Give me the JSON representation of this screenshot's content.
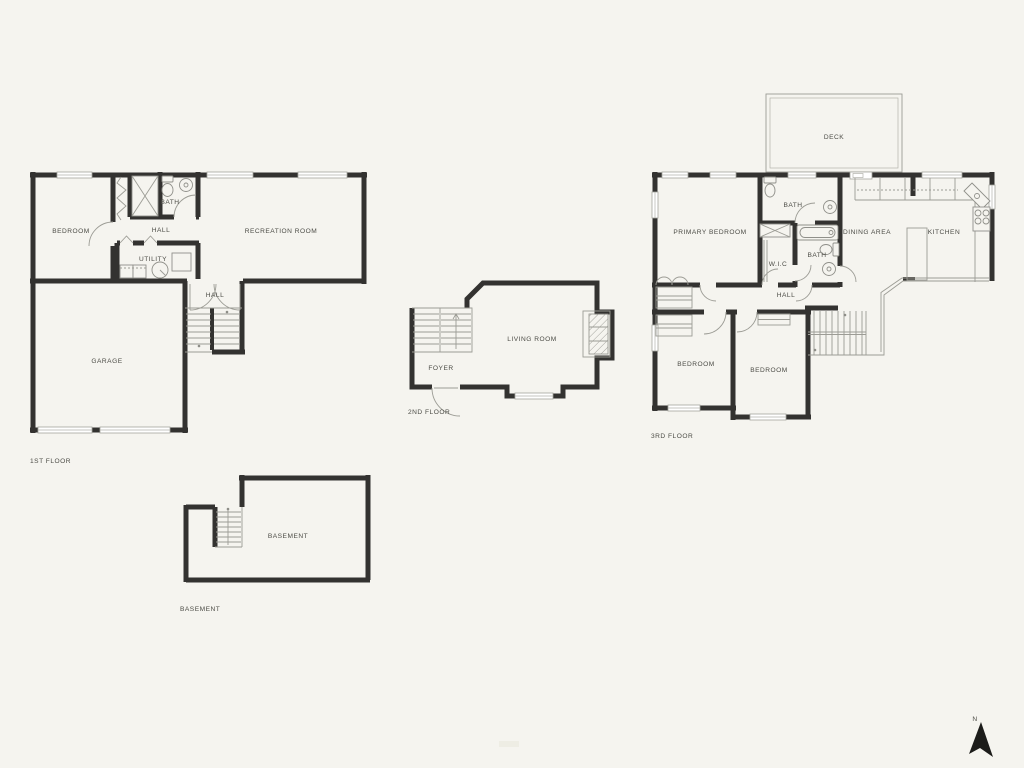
{
  "floors": {
    "first": {
      "caption": "1ST FLOOR",
      "rooms": {
        "bedroom": "BEDROOM",
        "bath": "BATH",
        "hall_upper": "HALL",
        "utility": "UTILITY",
        "recreation": "RECREATION ROOM",
        "hall_lower": "HALL",
        "garage": "GARAGE"
      }
    },
    "second": {
      "caption": "2ND FLOOR",
      "rooms": {
        "living": "LIVING ROOM",
        "foyer": "FOYER"
      }
    },
    "third": {
      "caption": "3RD FLOOR",
      "rooms": {
        "deck": "DECK",
        "primary_bedroom": "PRIMARY BEDROOM",
        "bath_upper": "BATH",
        "wic": "W.I.C",
        "bath_lower": "BATH",
        "dining": "DINING AREA",
        "kitchen": "KITCHEN",
        "hall": "HALL",
        "bedroom_left": "BEDROOM",
        "bedroom_right": "BEDROOM"
      }
    },
    "basement": {
      "caption": "BASEMENT",
      "rooms": {
        "basement": "BASEMENT"
      }
    }
  },
  "compass": {
    "label": "N"
  },
  "colors": {
    "background": "#f5f4ef",
    "walls": "#333230",
    "thin_lines": "#9c9c95",
    "text": "#4c4c46",
    "north_arrow": "#1c1c1a"
  }
}
